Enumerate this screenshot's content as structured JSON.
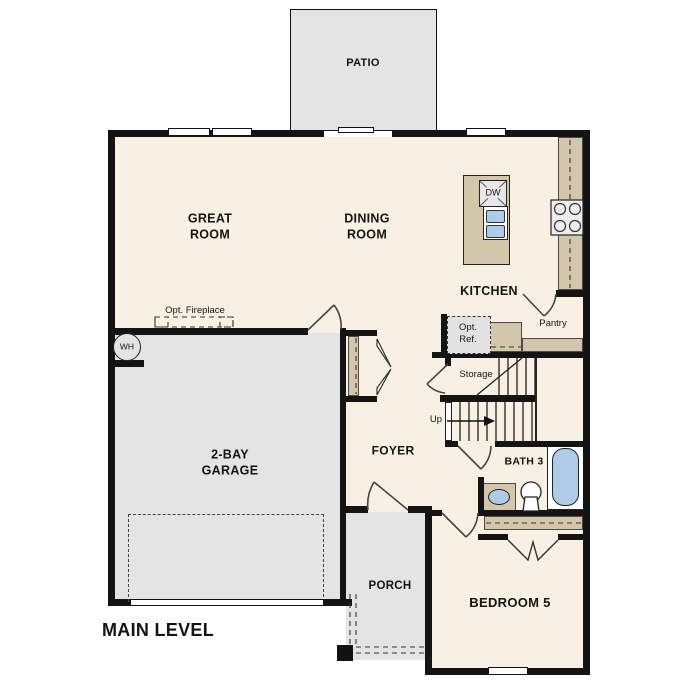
{
  "title": {
    "main_level": "MAIN LEVEL"
  },
  "rooms": {
    "patio": "PATIO",
    "great_room": "GREAT\nROOM",
    "dining_room": "DINING\nROOM",
    "kitchen": "KITCHEN",
    "pantry": "Pantry",
    "storage": "Storage",
    "foyer": "FOYER",
    "garage": "2-BAY\nGARAGE",
    "bath3": "BATH 3",
    "bedroom5": "BEDROOM 5",
    "porch": "PORCH"
  },
  "annotations": {
    "opt_fireplace": "Opt. Fireplace",
    "opt_ref": "Opt.\nRef.",
    "up": "Up",
    "wh": "WH",
    "dw": "DW"
  },
  "colors": {
    "floor": "#f8f0e2",
    "outdoor": "#e4e4e4",
    "counter": "#d3c6ab",
    "fixture": "#aecbe8",
    "wall": "#141414",
    "optref_fill": "#e2e2e2"
  }
}
